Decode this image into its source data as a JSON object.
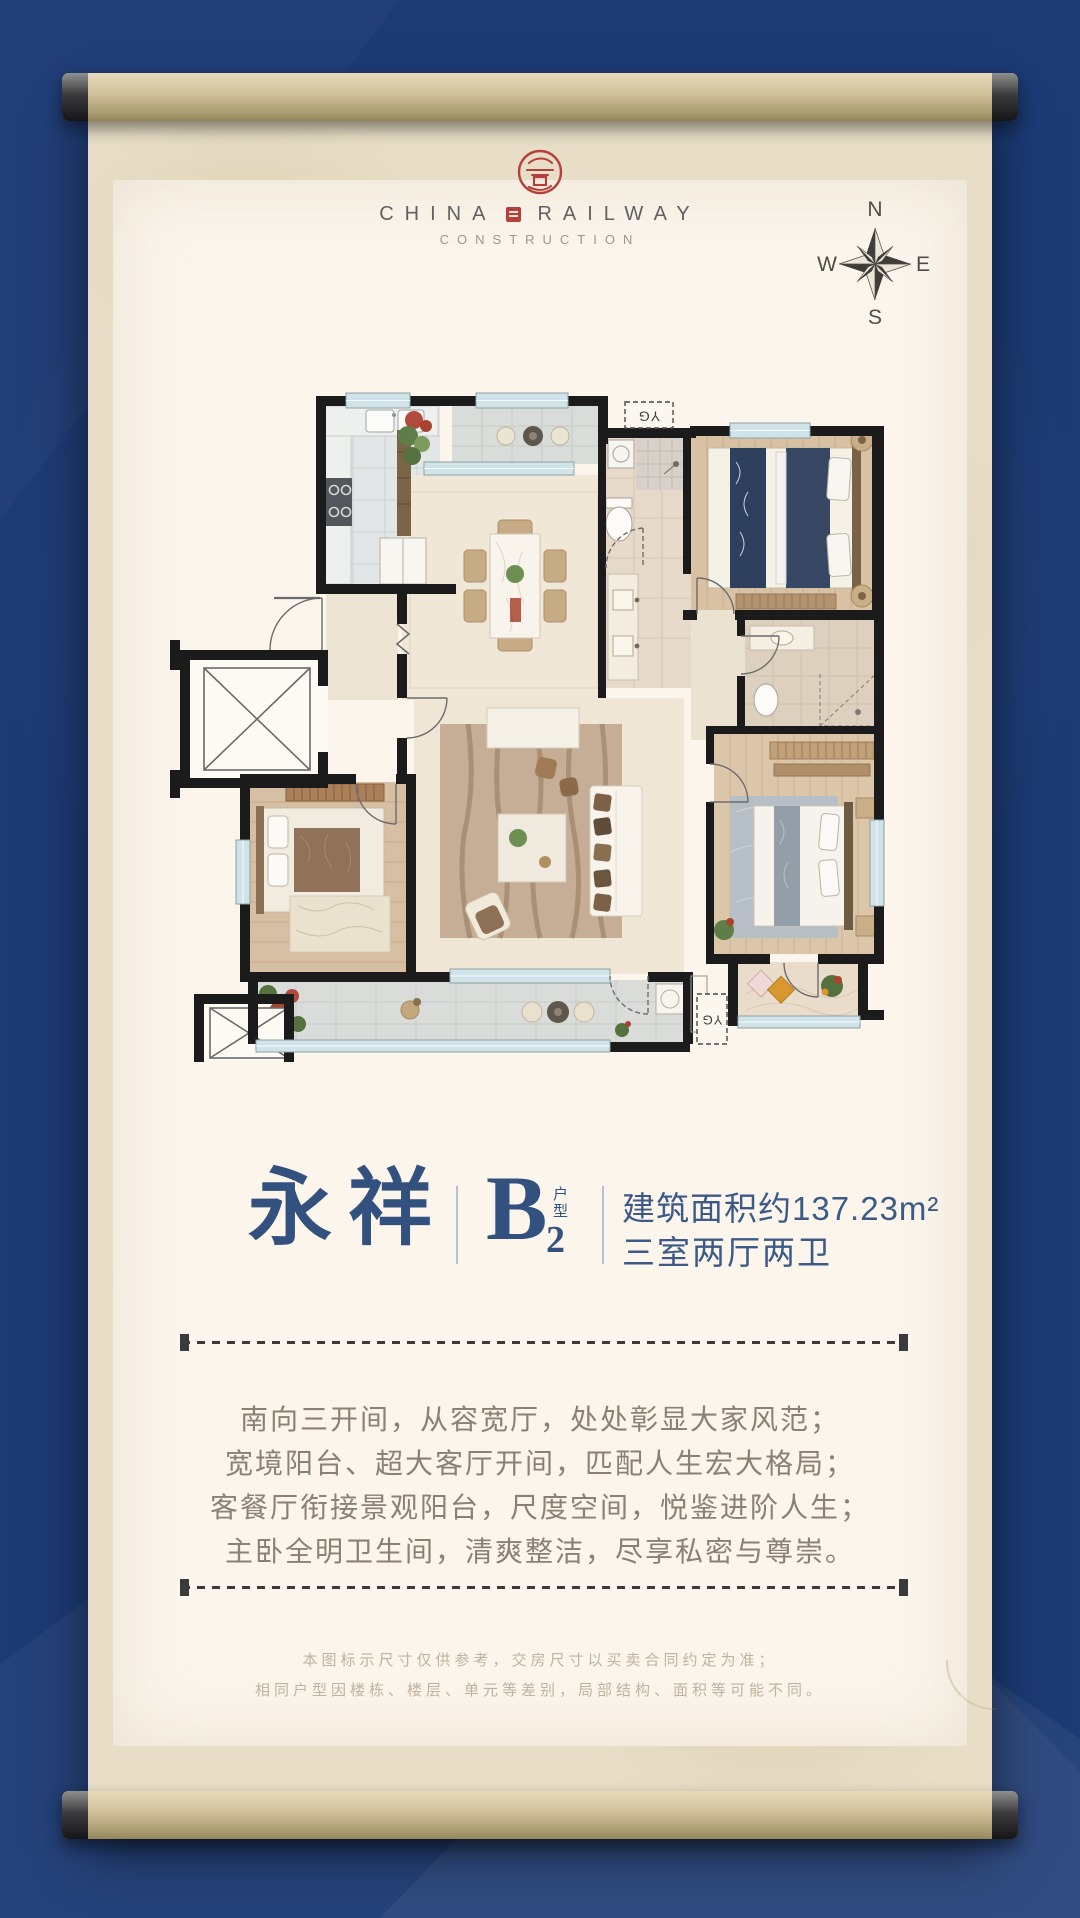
{
  "brand": {
    "china": "CHINA",
    "railway": "RAILWAY",
    "construction": "CONSTRUCTION"
  },
  "compass": {
    "north": "N",
    "south": "S",
    "east": "E",
    "west": "W"
  },
  "plan": {
    "flue_top": "YG",
    "flue_bottom": "YG"
  },
  "title": {
    "name": "永祥",
    "unit_letter": "B",
    "unit_number": "2",
    "unit_tag": "户型",
    "area": "建筑面积约137.23m²",
    "rooms": "三室两厅两卫"
  },
  "marketing": {
    "lines": [
      "南向三开间，从容宽厅，处处彰显大家风范；",
      "宽境阳台、超大客厅开间，匹配人生宏大格局；",
      "客餐厅衔接景观阳台，尺度空间，悦鉴进阶人生；",
      "主卧全明卫生间，清爽整洁，尽享私密与尊崇。"
    ]
  },
  "disclaimer": {
    "lines": [
      "本图标示尺寸仅供参考，交房尺寸以买卖合同约定为准；",
      "相同户型因楼栋、楼层、单元等差别，局部结构、面积等可能不同。"
    ]
  },
  "colors": {
    "background_navy": "#1c3a74",
    "parchment": "#e8dec7",
    "panel_cream": "#fbf5ec",
    "title_navy": "#33517f",
    "seal_red": "#b5403b",
    "wall_black": "#1b1b1b",
    "window_blue": "#cfe3e9"
  }
}
